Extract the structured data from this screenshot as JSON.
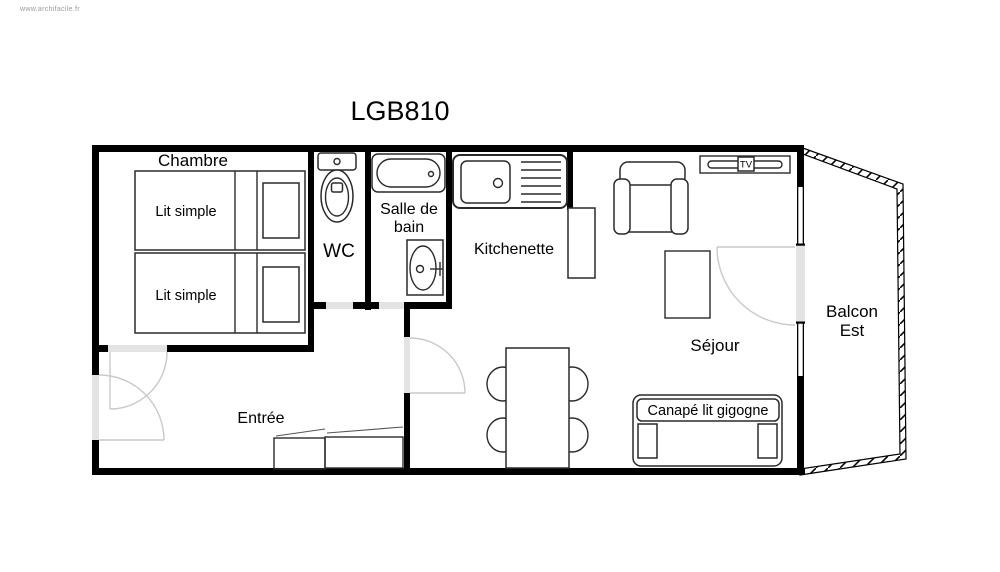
{
  "watermark": "www.archifacile.fr",
  "plan": {
    "title": "LGB810"
  },
  "colors": {
    "wall": "#000000",
    "opening": "#e3e3e3",
    "arc": "#c9c9c9",
    "furniture": "#2a2a2a",
    "text": "#000000",
    "muted": "#9a9a9a",
    "background": "#ffffff"
  },
  "rooms": {
    "chambre": {
      "label": "Chambre"
    },
    "wc": {
      "label": "WC"
    },
    "salle_de_bain": {
      "label_line1": "Salle de",
      "label_line2": "bain"
    },
    "kitchenette": {
      "label": "Kitchenette"
    },
    "sejour": {
      "label": "Séjour"
    },
    "entree": {
      "label": "Entrée"
    },
    "balcon": {
      "label_line1": "Balcon",
      "label_line2": "Est"
    }
  },
  "furniture": {
    "lit_simple_1": {
      "label": "Lit simple"
    },
    "lit_simple_2": {
      "label": "Lit simple"
    },
    "canape": {
      "label": "Canapé lit gigogne"
    },
    "tv": {
      "label": "TV"
    }
  }
}
